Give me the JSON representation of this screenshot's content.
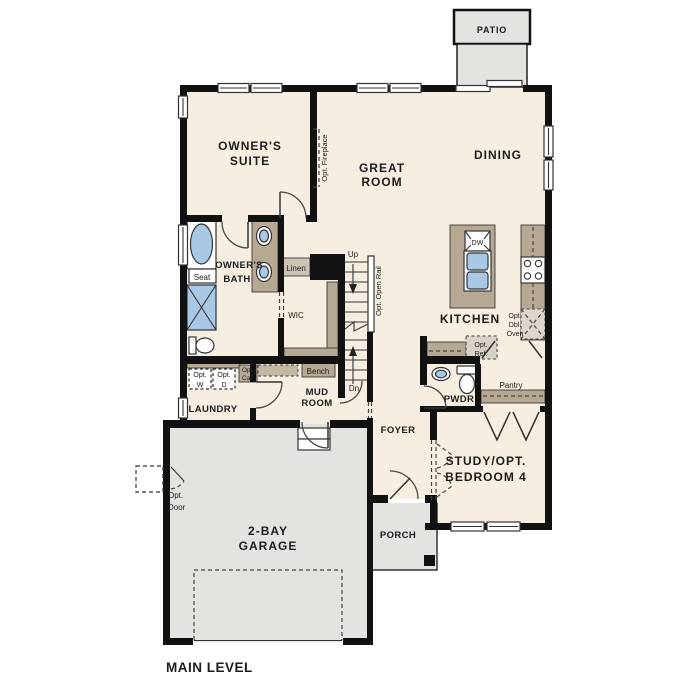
{
  "title": "MAIN LEVEL",
  "colors": {
    "floor": "#f6eee1",
    "concrete_gray": "#e4e3e0",
    "casework_tan": "#b7a894",
    "fixture_blue": "#a9c8e6",
    "wall_black": "#111111",
    "text": "#1c1c1c"
  },
  "rooms": {
    "patio": {
      "label": "PATIO"
    },
    "owners_suite": {
      "line1": "OWNER'S",
      "line2": "SUITE"
    },
    "great_room": {
      "line1": "GREAT",
      "line2": "ROOM"
    },
    "dining": {
      "label": "DINING"
    },
    "kitchen": {
      "label": "KITCHEN"
    },
    "owners_bath": {
      "line1": "OWNER'S",
      "line2": "BATH"
    },
    "wic": {
      "label": "WIC"
    },
    "laundry": {
      "label": "LAUNDRY"
    },
    "mud_room": {
      "line1": "MUD",
      "line2": "ROOM"
    },
    "foyer": {
      "label": "FOYER"
    },
    "pwdr": {
      "label": "PWDR"
    },
    "pantry": {
      "label": "Pantry"
    },
    "study": {
      "line1": "STUDY/OPT.",
      "line2": "BEDROOM 4"
    },
    "garage": {
      "line1": "2-BAY",
      "line2": "GARAGE"
    },
    "porch": {
      "label": "PORCH"
    }
  },
  "fixtures": {
    "dishwasher": "DW",
    "seat": "Seat",
    "linen": "Linen",
    "bench": "Bench",
    "stairs_up": "Up",
    "stairs_down": "Dn",
    "opt_washer_1": "Opt.",
    "opt_washer_2": "W",
    "opt_dryer_1": "Opt.",
    "opt_dryer_2": "D",
    "opt_cab_1": "Opt.",
    "opt_cab_2": "Cab",
    "opt_ref_1": "Opt.",
    "opt_ref_2": "Ref.",
    "opt_oven_1": "Opt.",
    "opt_oven_2": "Dbl.",
    "opt_oven_3": "Oven",
    "opt_fireplace": "Opt. Fireplace",
    "opt_open_rail": "Opt. Open Rail",
    "opt_door_1": "Opt.",
    "opt_door_2": "Door"
  }
}
